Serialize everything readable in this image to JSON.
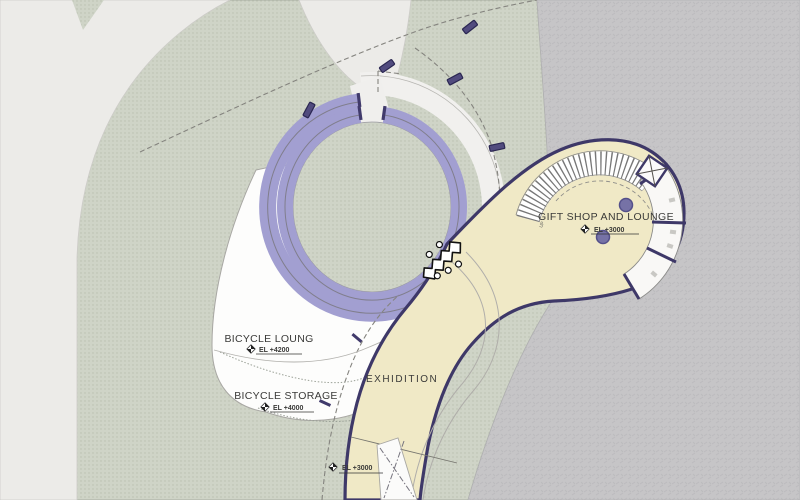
{
  "labels": {
    "bicycle_lounge": "BICYCLE LOUNG",
    "bicycle_lounge_el": "EL +4200",
    "bicycle_storage": "BICYCLE STORAGE",
    "bicycle_storage_el": "EL +4000",
    "exhibition": "EXHIDITION",
    "exhibition_el": "EL +3000",
    "gift_shop": "GIFT SHOP AND LOUNGE",
    "gift_shop_el": "EL +3000",
    "stair_up": "UP"
  },
  "colors": {
    "track_purple": "#a29fd1",
    "outline_navy": "#3e3868",
    "building_cream": "#f0e9c6",
    "landscape_green": "#ced3c7",
    "water_gray": "#c5c4c6",
    "path_light": "#ecebe8",
    "plaza_white": "#fdfdfc",
    "column_purple": "#514b7e",
    "text_dark": "#3a3a38"
  }
}
